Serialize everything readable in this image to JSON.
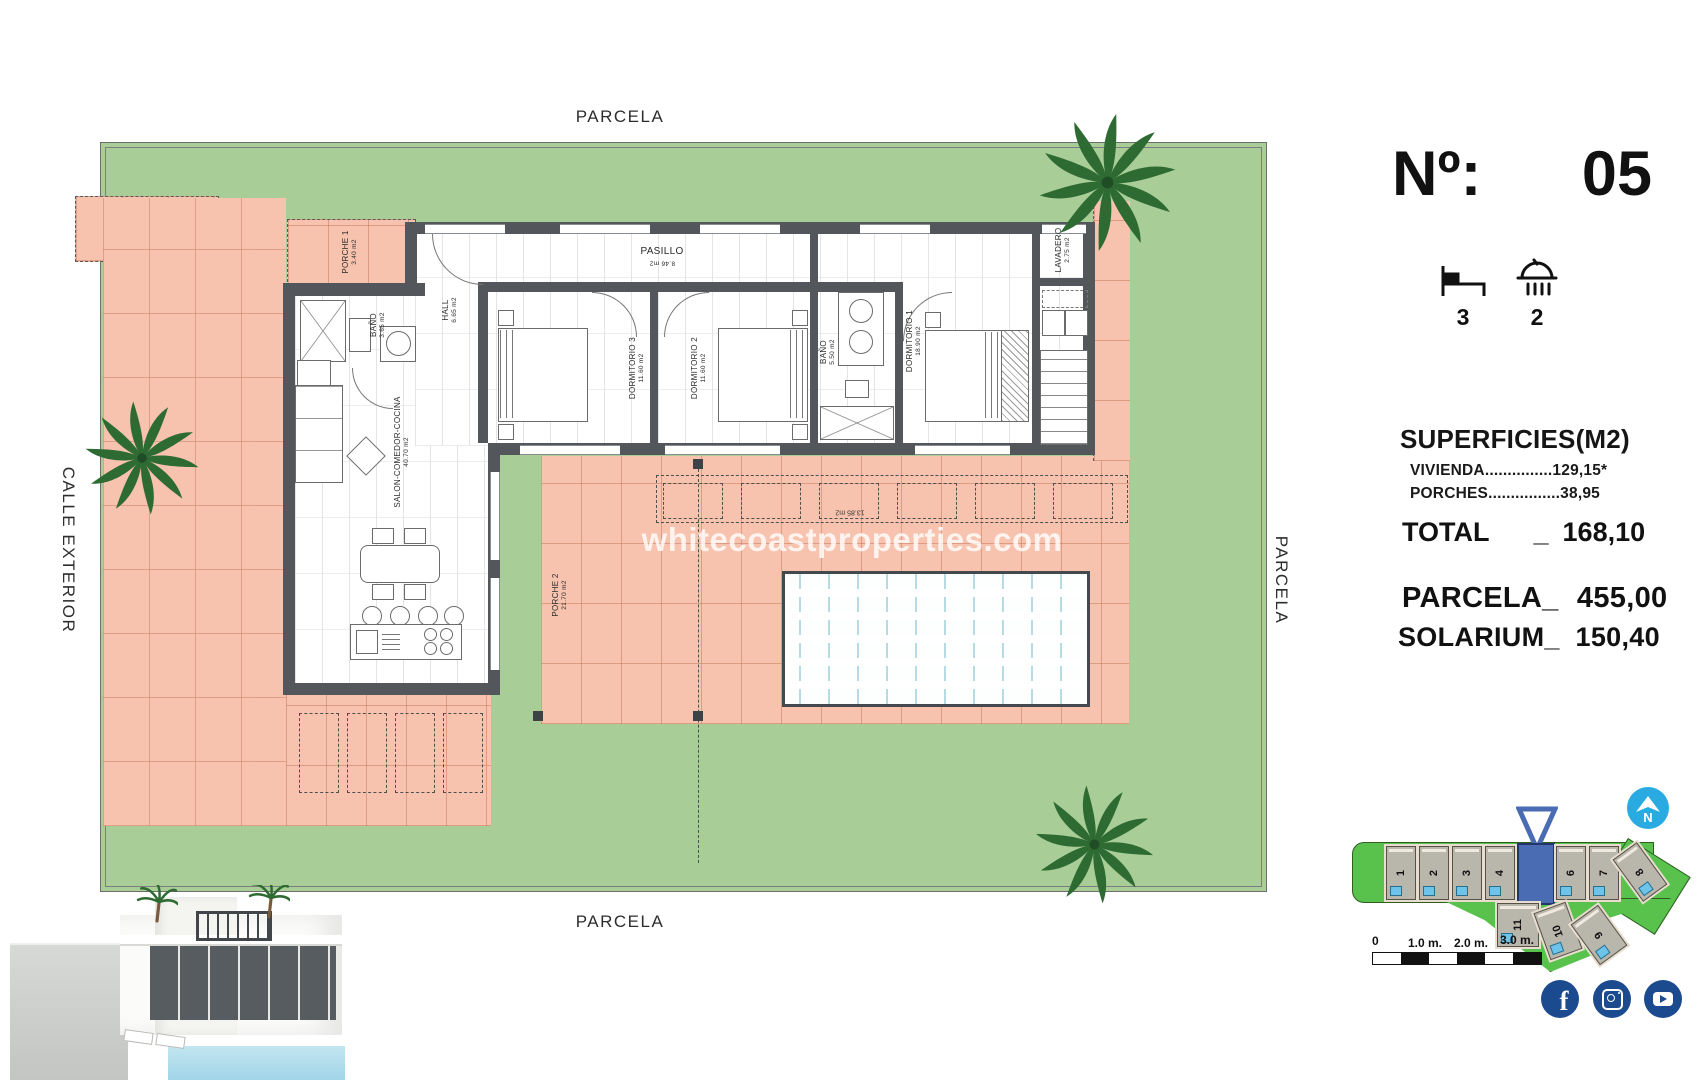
{
  "header": {
    "number_label": "Nº:",
    "number_value": "05",
    "beds_count": "3",
    "baths_count": "2"
  },
  "surfaces": {
    "title": "SUPERFICIES(M2)",
    "vivienda_label": "VIVIENDA",
    "vivienda_dots": "...............",
    "vivienda_value": "129,15*",
    "porches_label": "PORCHES",
    "porches_dots": "................",
    "porches_value": "38,95",
    "total_label": "TOTAL",
    "total_separator": "_",
    "total_value": "168,10",
    "parcela_label": "PARCELA_",
    "parcela_value": "455,00",
    "solarium_label": "SOLARIUM_",
    "solarium_value": "150,40"
  },
  "plan": {
    "boundary_top": "PARCELA",
    "boundary_bottom": "PARCELA",
    "boundary_left": "CALLE EXTERIOR",
    "boundary_right": "PARCELA",
    "watermark": "whitecoastproperties.com",
    "pergola_area": "13.85 m2",
    "rooms": [
      {
        "name": "PORCHE 1",
        "area": "3.40 m2"
      },
      {
        "name": "HALL",
        "area": "6.65 m2"
      },
      {
        "name": "BAÑO",
        "area": "3.65 m2"
      },
      {
        "name": "SALON-COMEDOR-COCINA",
        "area": "40.70 m2"
      },
      {
        "name": "PASILLO",
        "area": "8.46 m2"
      },
      {
        "name": "DORMITORIO 3",
        "area": "11.60 m2"
      },
      {
        "name": "DORMITORIO 2",
        "area": "11.60 m2"
      },
      {
        "name": "BAÑO",
        "area": "5.50 m2"
      },
      {
        "name": "DORMITORIO 1",
        "area": "18.90 m2"
      },
      {
        "name": "LAVADERO",
        "area": "2.75 m2"
      },
      {
        "name": "PORCHE 2",
        "area": "21.70 m2"
      }
    ]
  },
  "site_plan": {
    "plots": [
      "1",
      "2",
      "3",
      "4",
      "5",
      "6",
      "7",
      "8",
      "9",
      "10",
      "11"
    ],
    "highlighted_plot": "5",
    "scale_labels": [
      "0",
      "1.0 m.",
      "2.0 m.",
      "3.0 m."
    ]
  },
  "colors": {
    "lawn": "#a8cd96",
    "tile": "#f7c3ae",
    "wall": "#53575b",
    "highlight_blue": "#4a6cb3",
    "compass_blue": "#29abe2",
    "social_blue": "#1c4a8f"
  },
  "icons": {
    "bed": "bed-icon",
    "shower": "shower-icon",
    "compass": "compass-north-icon",
    "palm": "palm-tree-icon",
    "social": [
      "facebook-icon",
      "instagram-icon",
      "youtube-icon"
    ]
  }
}
